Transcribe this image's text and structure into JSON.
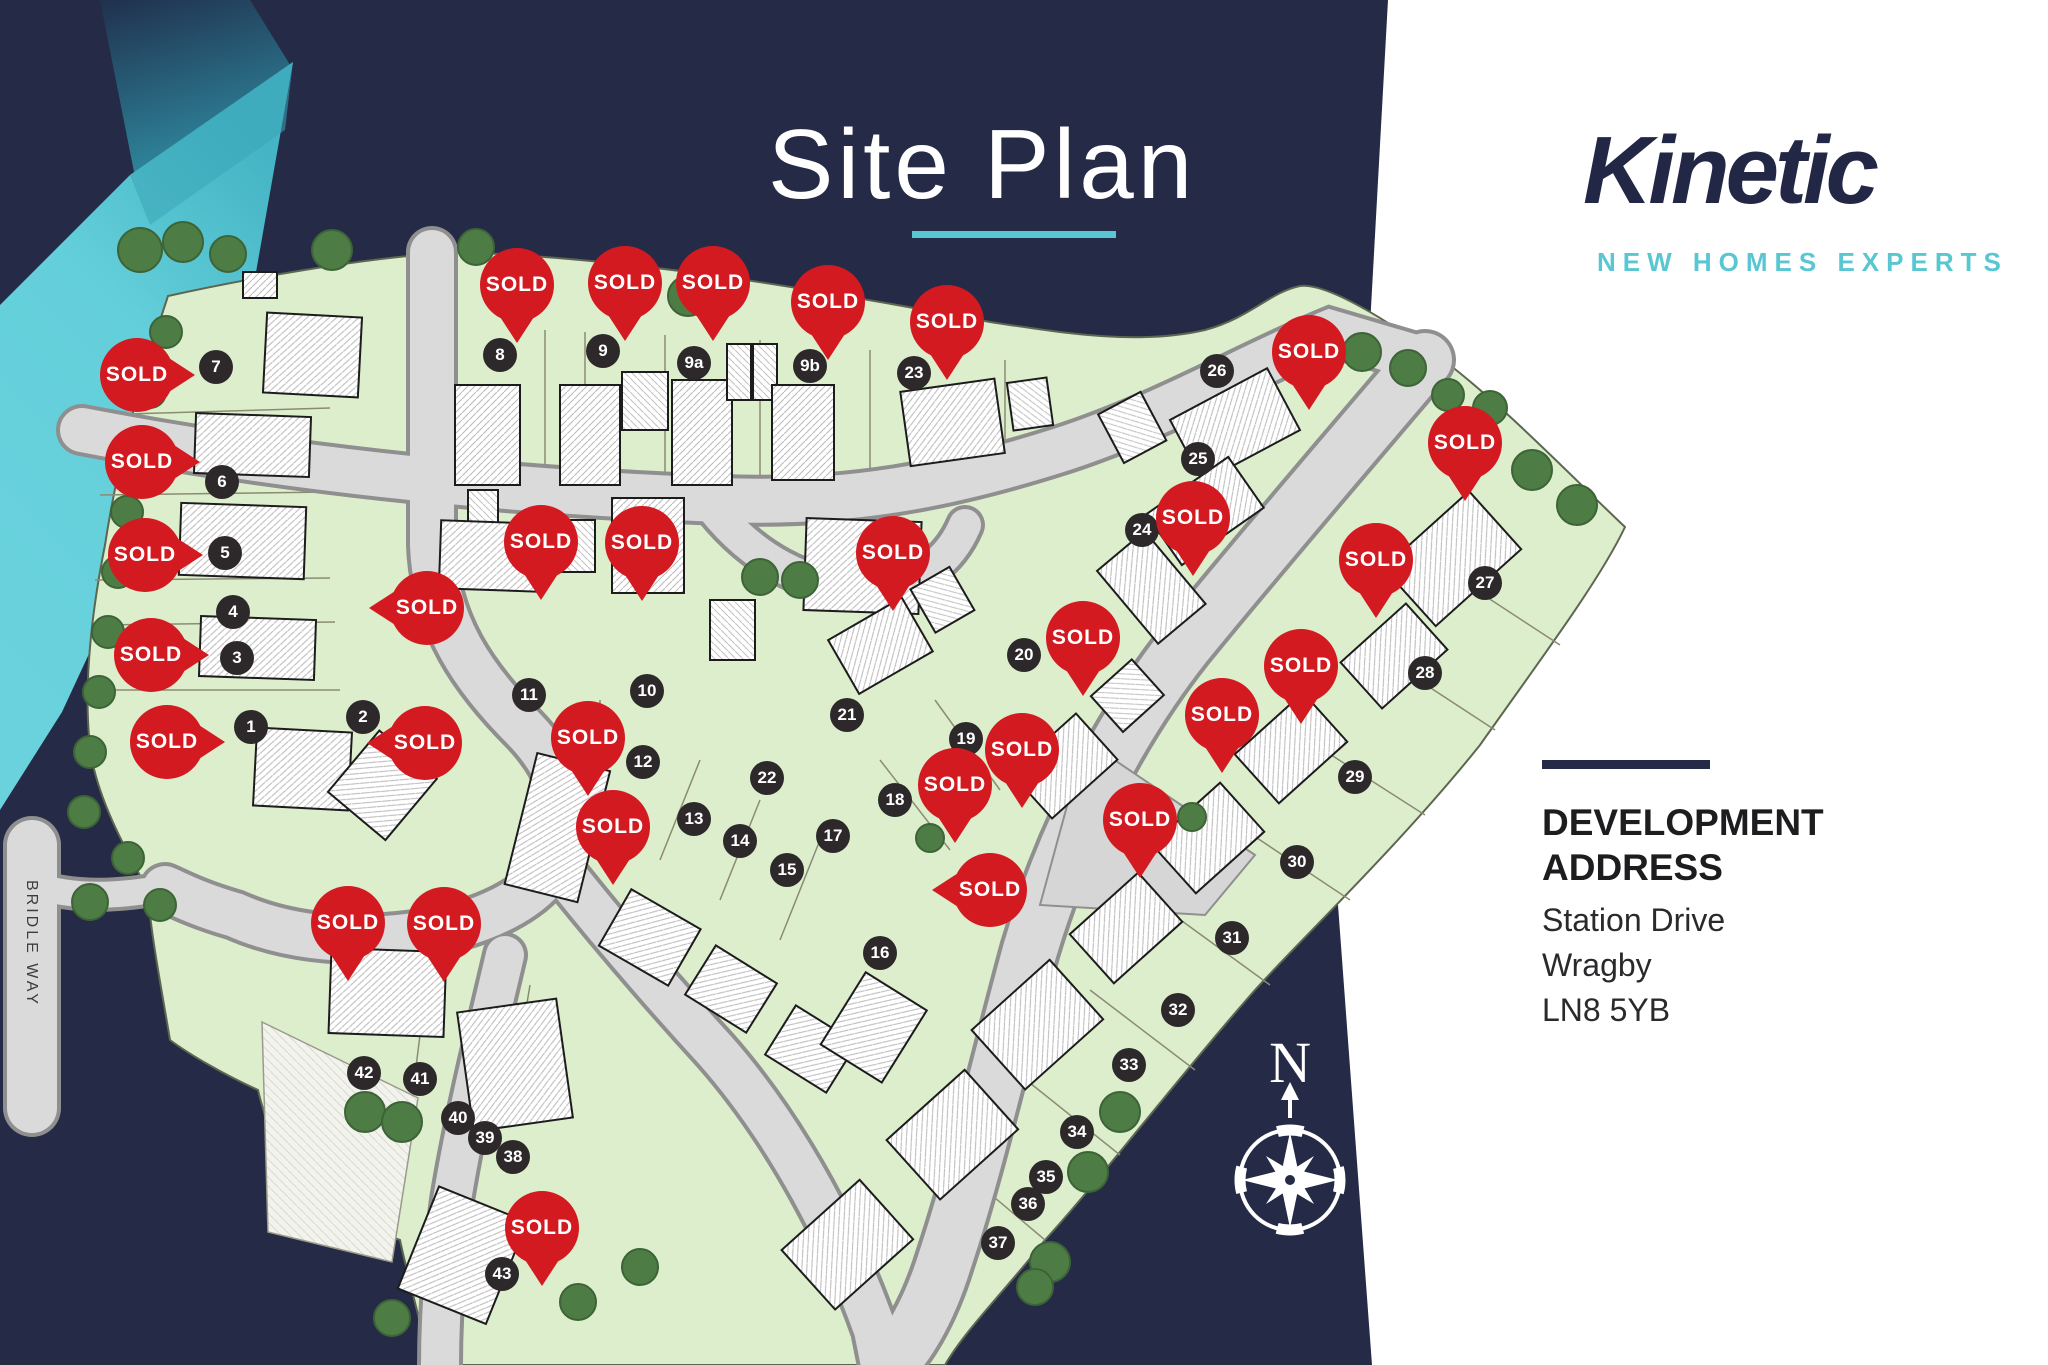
{
  "title": "Site Plan",
  "brand": {
    "name": "Kinetic",
    "tagline": "NEW HOMES EXPERTS"
  },
  "address": {
    "heading1": "DEVELOPMENT",
    "heading2": "ADDRESS",
    "lines": [
      "Station Drive",
      "Wragby",
      "LN8 5YB"
    ]
  },
  "colors": {
    "navy": "#252a47",
    "teal": "#58c7d2",
    "teal_dark": "#2e8fa5",
    "red": "#d31a20",
    "badge": "#2d292a",
    "green": "#ddeecd",
    "road": "#dadada",
    "white": "#ffffff",
    "text_dark": "#1d1d1f"
  },
  "map": {
    "road_label": "BRIDLE WAY",
    "compass_label": "N",
    "sold_label": "SOLD",
    "plots": [
      {
        "label": "1",
        "x": 251,
        "y": 727
      },
      {
        "label": "2",
        "x": 363,
        "y": 717
      },
      {
        "label": "3",
        "x": 237,
        "y": 658
      },
      {
        "label": "4",
        "x": 233,
        "y": 612
      },
      {
        "label": "5",
        "x": 225,
        "y": 553
      },
      {
        "label": "6",
        "x": 222,
        "y": 482
      },
      {
        "label": "7",
        "x": 216,
        "y": 367
      },
      {
        "label": "8",
        "x": 500,
        "y": 355
      },
      {
        "label": "9",
        "x": 603,
        "y": 351
      },
      {
        "label": "9a",
        "x": 694,
        "y": 363
      },
      {
        "label": "9b",
        "x": 810,
        "y": 366
      },
      {
        "label": "10",
        "x": 647,
        "y": 691
      },
      {
        "label": "11",
        "x": 529,
        "y": 695
      },
      {
        "label": "12",
        "x": 643,
        "y": 762
      },
      {
        "label": "13",
        "x": 694,
        "y": 819
      },
      {
        "label": "14",
        "x": 740,
        "y": 841
      },
      {
        "label": "15",
        "x": 787,
        "y": 870
      },
      {
        "label": "16",
        "x": 880,
        "y": 953
      },
      {
        "label": "17",
        "x": 833,
        "y": 836
      },
      {
        "label": "18",
        "x": 895,
        "y": 800
      },
      {
        "label": "19",
        "x": 966,
        "y": 739
      },
      {
        "label": "20",
        "x": 1024,
        "y": 655
      },
      {
        "label": "21",
        "x": 847,
        "y": 715
      },
      {
        "label": "22",
        "x": 767,
        "y": 778
      },
      {
        "label": "23",
        "x": 914,
        "y": 373
      },
      {
        "label": "24",
        "x": 1142,
        "y": 530
      },
      {
        "label": "25",
        "x": 1198,
        "y": 459
      },
      {
        "label": "26",
        "x": 1217,
        "y": 371
      },
      {
        "label": "27",
        "x": 1485,
        "y": 583
      },
      {
        "label": "28",
        "x": 1425,
        "y": 673
      },
      {
        "label": "29",
        "x": 1355,
        "y": 777
      },
      {
        "label": "30",
        "x": 1297,
        "y": 862
      },
      {
        "label": "31",
        "x": 1232,
        "y": 938
      },
      {
        "label": "32",
        "x": 1178,
        "y": 1010
      },
      {
        "label": "33",
        "x": 1129,
        "y": 1065
      },
      {
        "label": "34",
        "x": 1077,
        "y": 1132
      },
      {
        "label": "35",
        "x": 1046,
        "y": 1177
      },
      {
        "label": "36",
        "x": 1028,
        "y": 1204
      },
      {
        "label": "37",
        "x": 998,
        "y": 1243
      },
      {
        "label": "38",
        "x": 513,
        "y": 1157
      },
      {
        "label": "39",
        "x": 485,
        "y": 1138
      },
      {
        "label": "40",
        "x": 458,
        "y": 1118
      },
      {
        "label": "41",
        "x": 420,
        "y": 1079
      },
      {
        "label": "42",
        "x": 364,
        "y": 1073
      },
      {
        "label": "43",
        "x": 502,
        "y": 1274
      }
    ],
    "pins": [
      {
        "x": 517,
        "y": 285,
        "dir": "down",
        "near": "8"
      },
      {
        "x": 625,
        "y": 283,
        "dir": "down",
        "near": "9"
      },
      {
        "x": 713,
        "y": 283,
        "dir": "down",
        "near": "9a"
      },
      {
        "x": 828,
        "y": 302,
        "dir": "down",
        "near": "9b"
      },
      {
        "x": 947,
        "y": 322,
        "dir": "down",
        "near": "23"
      },
      {
        "x": 1309,
        "y": 352,
        "dir": "down",
        "near": "26"
      },
      {
        "x": 137,
        "y": 375,
        "dir": "right",
        "near": "7"
      },
      {
        "x": 142,
        "y": 462,
        "dir": "right",
        "near": "6"
      },
      {
        "x": 145,
        "y": 555,
        "dir": "right",
        "near": "5"
      },
      {
        "x": 151,
        "y": 655,
        "dir": "right",
        "near": "3"
      },
      {
        "x": 167,
        "y": 742,
        "dir": "right",
        "near": "1"
      },
      {
        "x": 427,
        "y": 608,
        "dir": "left",
        "near": "4"
      },
      {
        "x": 425,
        "y": 743,
        "dir": "left",
        "near": "2"
      },
      {
        "x": 541,
        "y": 542,
        "dir": "down",
        "near": "11"
      },
      {
        "x": 642,
        "y": 543,
        "dir": "down",
        "near": "10"
      },
      {
        "x": 588,
        "y": 738,
        "dir": "down",
        "near": "12"
      },
      {
        "x": 613,
        "y": 827,
        "dir": "down",
        "near": "13"
      },
      {
        "x": 893,
        "y": 553,
        "dir": "down",
        "near": "21"
      },
      {
        "x": 1022,
        "y": 750,
        "dir": "down",
        "near": "19"
      },
      {
        "x": 955,
        "y": 785,
        "dir": "down",
        "near": "18"
      },
      {
        "x": 990,
        "y": 890,
        "dir": "left",
        "near": "16"
      },
      {
        "x": 1083,
        "y": 638,
        "dir": "down",
        "near": "20"
      },
      {
        "x": 1140,
        "y": 820,
        "dir": "down",
        "near": "31"
      },
      {
        "x": 1222,
        "y": 715,
        "dir": "down",
        "near": "30"
      },
      {
        "x": 1301,
        "y": 666,
        "dir": "down",
        "near": "29"
      },
      {
        "x": 1376,
        "y": 560,
        "dir": "down",
        "near": "28"
      },
      {
        "x": 1465,
        "y": 443,
        "dir": "down",
        "near": "27"
      },
      {
        "x": 1193,
        "y": 518,
        "dir": "down",
        "near": "24"
      },
      {
        "x": 348,
        "y": 923,
        "dir": "down",
        "near": "42"
      },
      {
        "x": 444,
        "y": 924,
        "dir": "down",
        "near": "41"
      },
      {
        "x": 542,
        "y": 1228,
        "dir": "down",
        "near": "43"
      }
    ]
  }
}
